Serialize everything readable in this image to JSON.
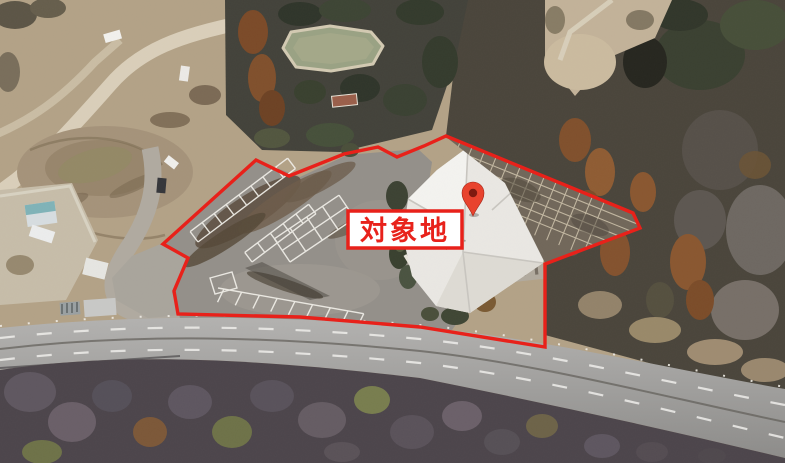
{
  "annotation": {
    "site_label": "対象地",
    "boundary_color": "#e8211a",
    "label_background": "#ffffff",
    "label_border_color": "#e8211a",
    "label_text_color": "#e8221b",
    "pin_icon": "location-pin",
    "pin_color": "#e8432e",
    "pin_inner_color": "#7e1a10"
  }
}
